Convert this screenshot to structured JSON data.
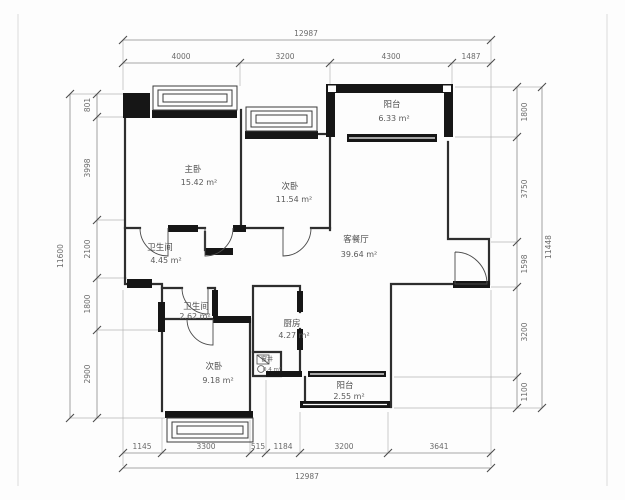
{
  "plan_title": "residential-floor-plan",
  "rooms": {
    "master": {
      "name": "主卧",
      "area": "15.42 m²"
    },
    "bed2": {
      "name": "次卧",
      "area": "11.54 m²"
    },
    "balcony_top": {
      "name": "阳台",
      "area": "6.33 m²"
    },
    "living": {
      "name": "客餐厅",
      "area": "39.64 m²"
    },
    "bath1": {
      "name": "卫生间",
      "area": "4.45 m²"
    },
    "bath2": {
      "name": "卫生间",
      "area": "2.62 m²"
    },
    "kitchen": {
      "name": "厨房",
      "area": "4.27 m²"
    },
    "shaft": {
      "name": "窗井",
      "area": "0.4 m²"
    },
    "bed3": {
      "name": "次卧",
      "area": "9.18 m²"
    },
    "balcony_bottom": {
      "name": "阳台",
      "area": "2.55 m²"
    }
  },
  "dimensions": {
    "top": {
      "total": "12987",
      "segments": [
        "4000",
        "3200",
        "4300",
        "1487"
      ]
    },
    "bottom": {
      "total": "12987",
      "segments": [
        "1145",
        "3300",
        "515",
        "1184",
        "3200",
        "3641"
      ]
    },
    "left": {
      "total": "11600",
      "segments": [
        "801",
        "3998",
        "2100",
        "1800",
        "2900"
      ]
    },
    "right": {
      "total": "11448",
      "segments": [
        "1800",
        "3750",
        "1598",
        "3200",
        "1100"
      ]
    }
  },
  "colors": {
    "wall": "#2e2e2e",
    "solid_wall_fill": "#161616",
    "dim_line": "#8a8a8a",
    "background": "#fdfdfd"
  }
}
